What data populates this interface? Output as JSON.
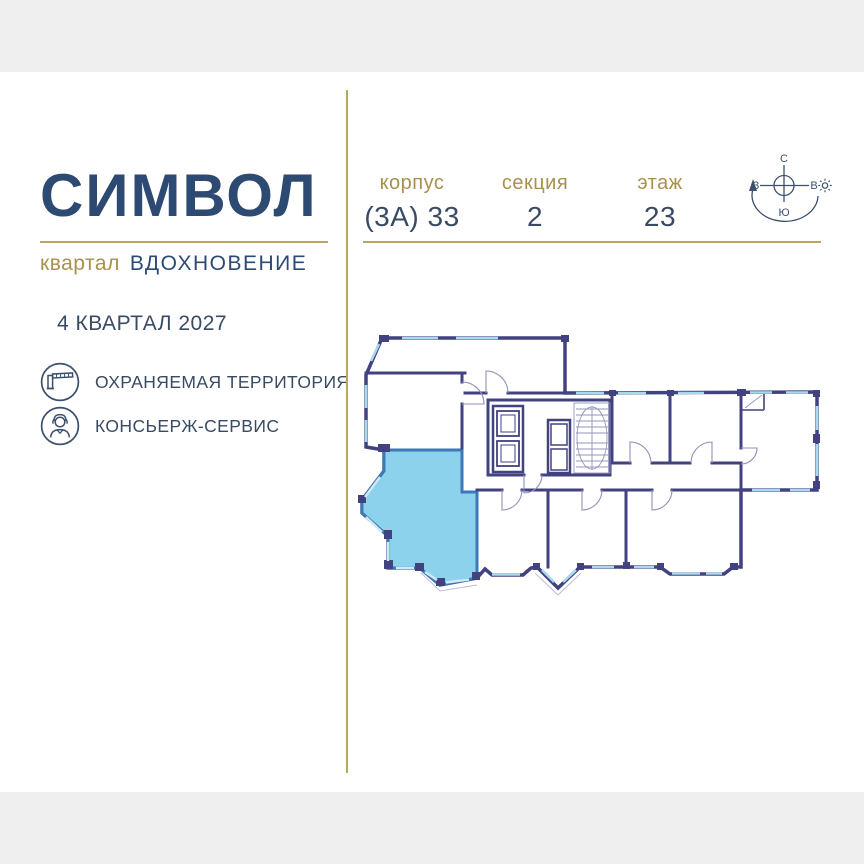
{
  "brand": {
    "logo": "СИМВОЛ",
    "sub_prefix": "квартал",
    "sub_name": "ВДОХНОВЕНИЕ",
    "completion": "4 КВАРТАЛ 2027",
    "features": [
      {
        "icon": "barrier-icon",
        "label": "ОХРАНЯЕМАЯ ТЕРРИТОРИЯ"
      },
      {
        "icon": "concierge-icon",
        "label": "КОНСЬЕРЖ-СЕРВИС"
      }
    ]
  },
  "header": {
    "columns": [
      {
        "label": "корпус",
        "value": "(3А) 33"
      },
      {
        "label": "секция",
        "value": "2"
      },
      {
        "label": "этаж",
        "value": "23"
      }
    ]
  },
  "compass": {
    "north": "С",
    "south": "Ю",
    "west": "З",
    "east": "В"
  },
  "floor_plan": {
    "highlighted_unit_fill": "#8DD2EC",
    "highlighted_unit_stroke": "#3B79B8",
    "wall_color": "#424280",
    "window_color": "#A9D9EC",
    "thin_line_color": "#9595BF"
  },
  "colors": {
    "navy_text": "#2D4A72",
    "value_text": "#394B63",
    "gold_text": "#A9904E",
    "gold_line": "#B7A664",
    "background": "#FFFFFF",
    "letterbox": "#EFEFEF"
  }
}
